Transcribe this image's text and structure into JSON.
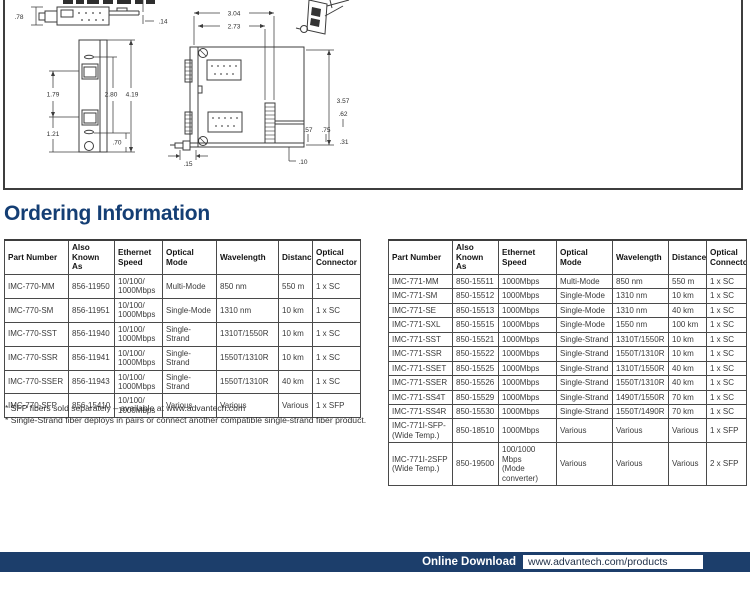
{
  "page_title": "Ordering Information",
  "colors": {
    "accent": "#143e74",
    "bar": "#1c3e6b"
  },
  "drawing": {
    "dims": {
      "d78": ".78",
      "d14": ".14",
      "d179": "1.79",
      "d280": "2.80",
      "d419": "4.19",
      "d121": "1.21",
      "d70": ".70",
      "d304": "3.04",
      "d273": "2.73",
      "d357": "3.57",
      "d62": ".62",
      "d57": ".57",
      "d75": ".75",
      "d31": ".31",
      "d10": ".10",
      "d15": ".15"
    }
  },
  "tables": {
    "headers": [
      "Part Number",
      "Also\nKnown As",
      "Ethernet\nSpeed",
      "Optical\nMode",
      "Wavelength",
      "Distance",
      "Optical\nConnector"
    ],
    "imc770": {
      "rows": [
        [
          "IMC-770-MM",
          "856-11950",
          "10/100/\n1000Mbps",
          "Multi-Mode",
          "850 nm",
          "550 m",
          "1 x SC"
        ],
        [
          "IMC-770-SM",
          "856-11951",
          "10/100/\n1000Mbps",
          "Single-Mode",
          "1310 nm",
          "10 km",
          "1 x SC"
        ],
        [
          "IMC-770-SST",
          "856-11940",
          "10/100/\n1000Mbps",
          "Single-Strand",
          "1310T/1550R",
          "10 km",
          "1 x SC"
        ],
        [
          "IMC-770-SSR",
          "856-11941",
          "10/100/\n1000Mbps",
          "Single-Strand",
          "1550T/1310R",
          "10 km",
          "1 x SC"
        ],
        [
          "IMC-770-SSER",
          "856-11943",
          "10/100/\n1000Mbps",
          "Single-Strand",
          "1550T/1310R",
          "40 km",
          "1 x SC"
        ],
        [
          "IMC-770-SFP",
          "856-15410",
          "10/100/\n1000Mbps",
          "Various",
          "Various",
          "Various",
          "1 x SFP"
        ]
      ]
    },
    "imc771": {
      "rows": [
        [
          "IMC-771-MM",
          "850-15511",
          "1000Mbps",
          "Multi-Mode",
          "850 nm",
          "550 m",
          "1 x SC"
        ],
        [
          "IMC-771-SM",
          "850-15512",
          "1000Mbps",
          "Single-Mode",
          "1310 nm",
          "10 km",
          "1 x SC"
        ],
        [
          "IMC-771-SE",
          "850-15513",
          "1000Mbps",
          "Single-Mode",
          "1310 nm",
          "40 km",
          "1 x SC"
        ],
        [
          "IMC-771-SXL",
          "850-15515",
          "1000Mbps",
          "Single-Mode",
          "1550 nm",
          "100 km",
          "1 x SC"
        ],
        [
          "IMC-771-SST",
          "850-15521",
          "1000Mbps",
          "Single-Strand",
          "1310T/1550R",
          "10 km",
          "1 x SC"
        ],
        [
          "IMC-771-SSR",
          "850-15522",
          "1000Mbps",
          "Single-Strand",
          "1550T/1310R",
          "10 km",
          "1 x SC"
        ],
        [
          "IMC-771-SSET",
          "850-15525",
          "1000Mbps",
          "Single-Strand",
          "1310T/1550R",
          "40 km",
          "1 x SC"
        ],
        [
          "IMC-771-SSER",
          "850-15526",
          "1000Mbps",
          "Single-Strand",
          "1550T/1310R",
          "40 km",
          "1 x SC"
        ],
        [
          "IMC-771-SS4T",
          "850-15529",
          "1000Mbps",
          "Single-Strand",
          "1490T/1550R",
          "70 km",
          "1 x SC"
        ],
        [
          "IMC-771-SS4R",
          "850-15530",
          "1000Mbps",
          "Single-Strand",
          "1550T/1490R",
          "70 km",
          "1 x SC"
        ],
        [
          "IMC-771I-SFP-\n(Wide Temp.)",
          "850-18510",
          "1000Mbps",
          "Various",
          "Various",
          "Various",
          "1 x SFP"
        ],
        [
          "IMC-771I-2SFP\n(Wide Temp.)",
          "850-19500",
          "100/1000 Mbps\n(Mode\nconverter)",
          "Various",
          "Various",
          "Various",
          "2 x SFP"
        ]
      ]
    }
  },
  "footnotes": [
    "* SFP fibers sold separately – available at www.advantech.com",
    "* Single-Strand fiber deploys in pairs or connect another compatible single-strand fiber product."
  ],
  "footer": {
    "label": "Online Download",
    "url": "www.advantech.com/products"
  }
}
